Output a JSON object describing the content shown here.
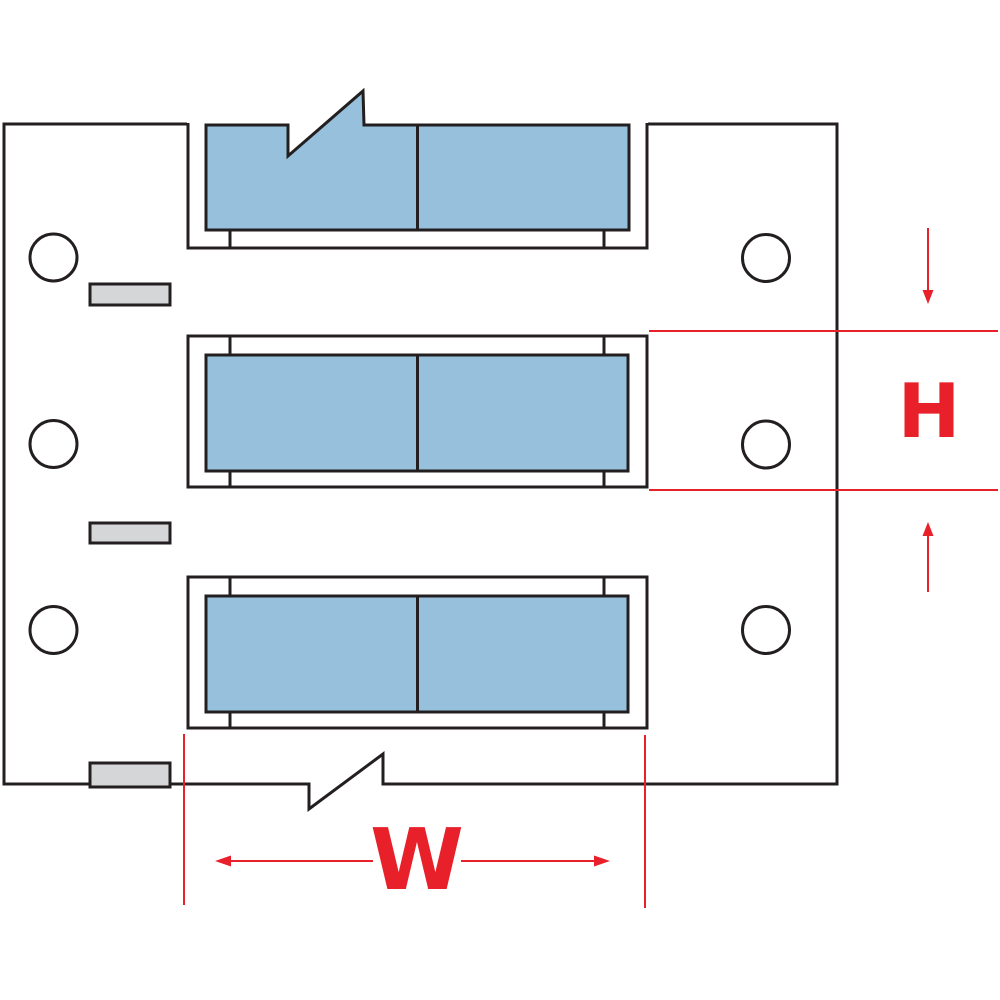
{
  "figure": {
    "type": "technical-diagram",
    "subject": "Wire marker sleeve label strip with width and height dimension callouts",
    "label_rows": 3,
    "sleeves_per_row": 2,
    "feed_holes": 6,
    "registration_marks": 3
  },
  "labels": {
    "height": "H",
    "width": "W"
  },
  "colors": {
    "sleeve-blue": "#97c0dc",
    "line-black": "#231f20",
    "dimension-red": "#e8202a",
    "mark-gray": "#d4d6d7",
    "background": "#ffffff"
  }
}
